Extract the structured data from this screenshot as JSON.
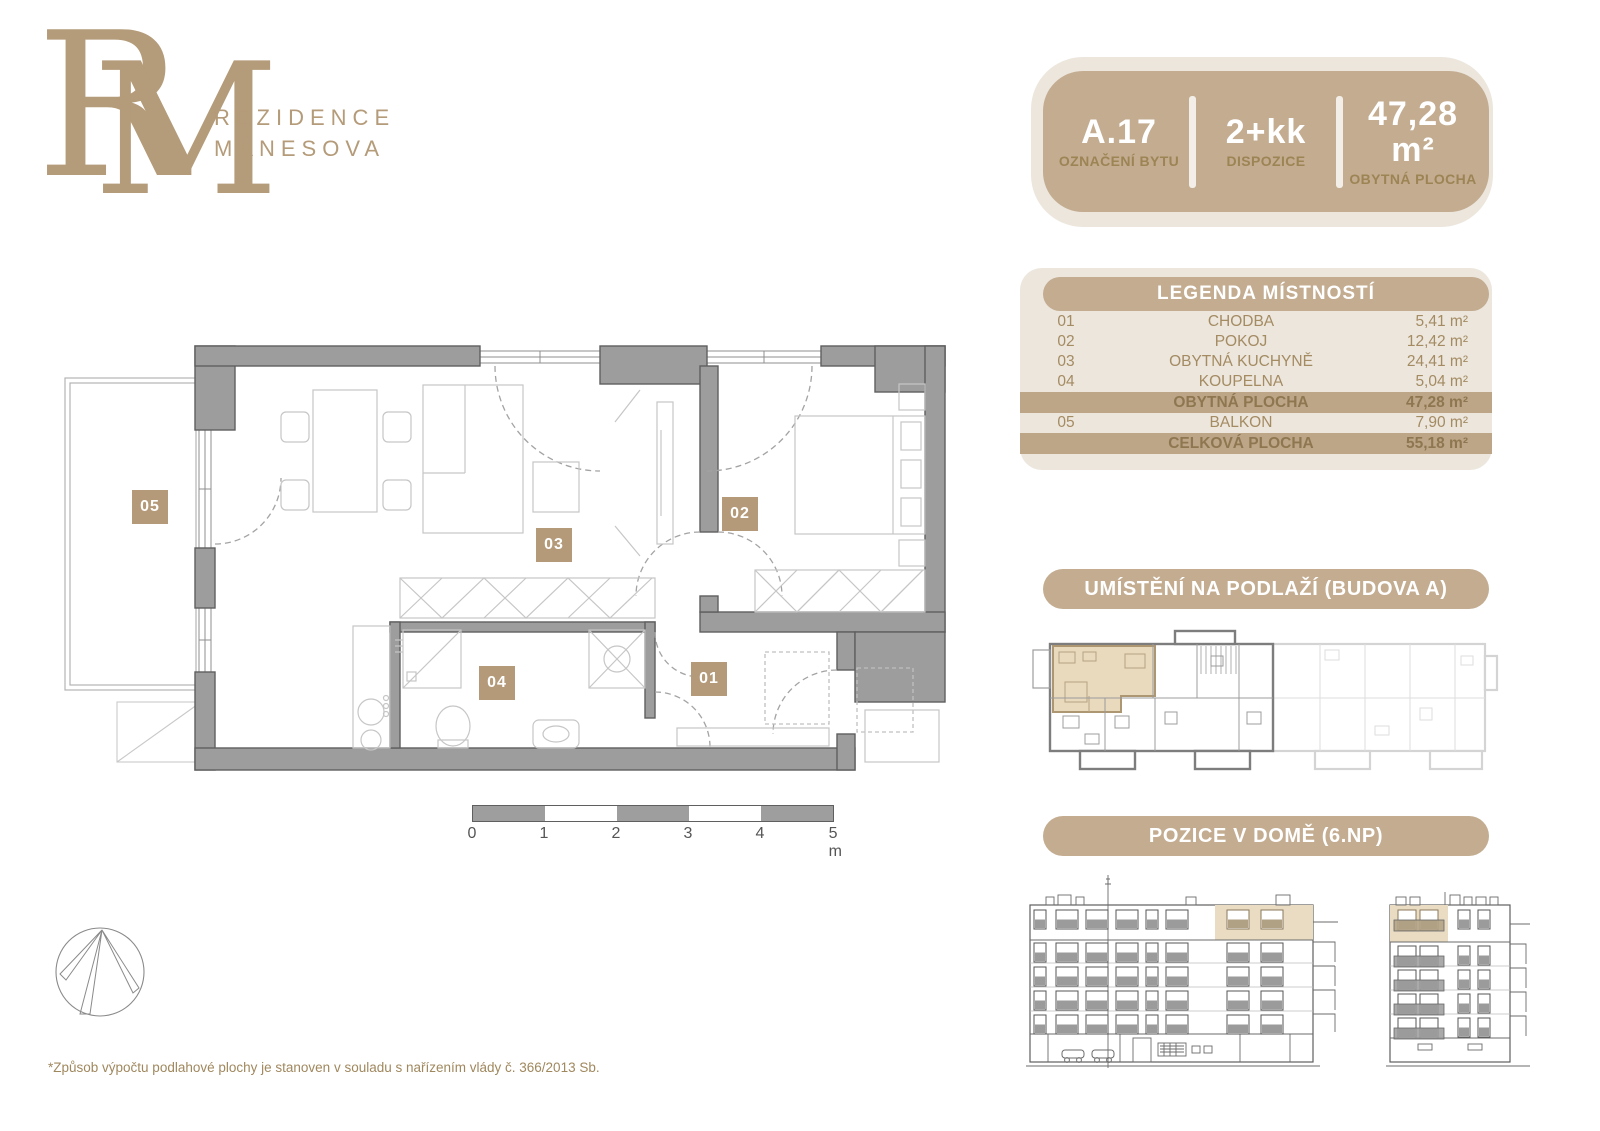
{
  "brand": {
    "monogram_r": "R",
    "monogram_m": "M",
    "line1": "REZIDENCE",
    "line2": "MÁNESOVA"
  },
  "unit_card": {
    "cells": [
      {
        "value": "A.17",
        "label": "OZNAČENÍ BYTU"
      },
      {
        "value": "2+kk",
        "label": "DISPOZICE"
      },
      {
        "value": "47,28 m²",
        "label": "OBYTNÁ PLOCHA"
      }
    ]
  },
  "legend": {
    "title": "LEGENDA MÍSTNOSTÍ",
    "rows": [
      {
        "num": "01",
        "name": "CHODBA",
        "area": "5,41 m²",
        "highlight": false
      },
      {
        "num": "02",
        "name": "POKOJ",
        "area": "12,42 m²",
        "highlight": false
      },
      {
        "num": "03",
        "name": "OBYTNÁ KUCHYNĚ",
        "area": "24,41 m²",
        "highlight": false
      },
      {
        "num": "04",
        "name": "KOUPELNA",
        "area": "5,04 m²",
        "highlight": false
      },
      {
        "num": "",
        "name": "OBYTNÁ PLOCHA",
        "area": "47,28 m²",
        "highlight": true
      },
      {
        "num": "05",
        "name": "BALKON",
        "area": "7,90 m²",
        "highlight": false
      },
      {
        "num": "",
        "name": "CELKOVÁ PLOCHA",
        "area": "55,18 m²",
        "highlight": true
      }
    ]
  },
  "sections": {
    "floor_location": "UMÍSTĚNÍ NA PODLAŽÍ (BUDOVA A)",
    "house_position": "POZICE V DOMĚ (6.NP)"
  },
  "floorplan": {
    "labels": [
      {
        "id": "05"
      },
      {
        "id": "03"
      },
      {
        "id": "02"
      },
      {
        "id": "04"
      },
      {
        "id": "01"
      }
    ],
    "scale_ticks": [
      "0",
      "1",
      "2",
      "3",
      "4",
      "5 m"
    ]
  },
  "footnote": "*Způsob výpočtu podlahové plochy je stanoven v souladu s nařízením vlády č. 366/2013 Sb.",
  "colors": {
    "tan": "#c3ac90",
    "beige": "#ece6dd",
    "gold": "#a48b62",
    "gold_dark": "#8e7750",
    "chip": "#b49a78",
    "band": "#bda687",
    "highlight_fill": "#e9dcc3",
    "wall": "#9d9d9d",
    "wall_stroke": "#5f5f5f",
    "logo": "#b49b79",
    "scale_gray": "#9e9e9e"
  }
}
